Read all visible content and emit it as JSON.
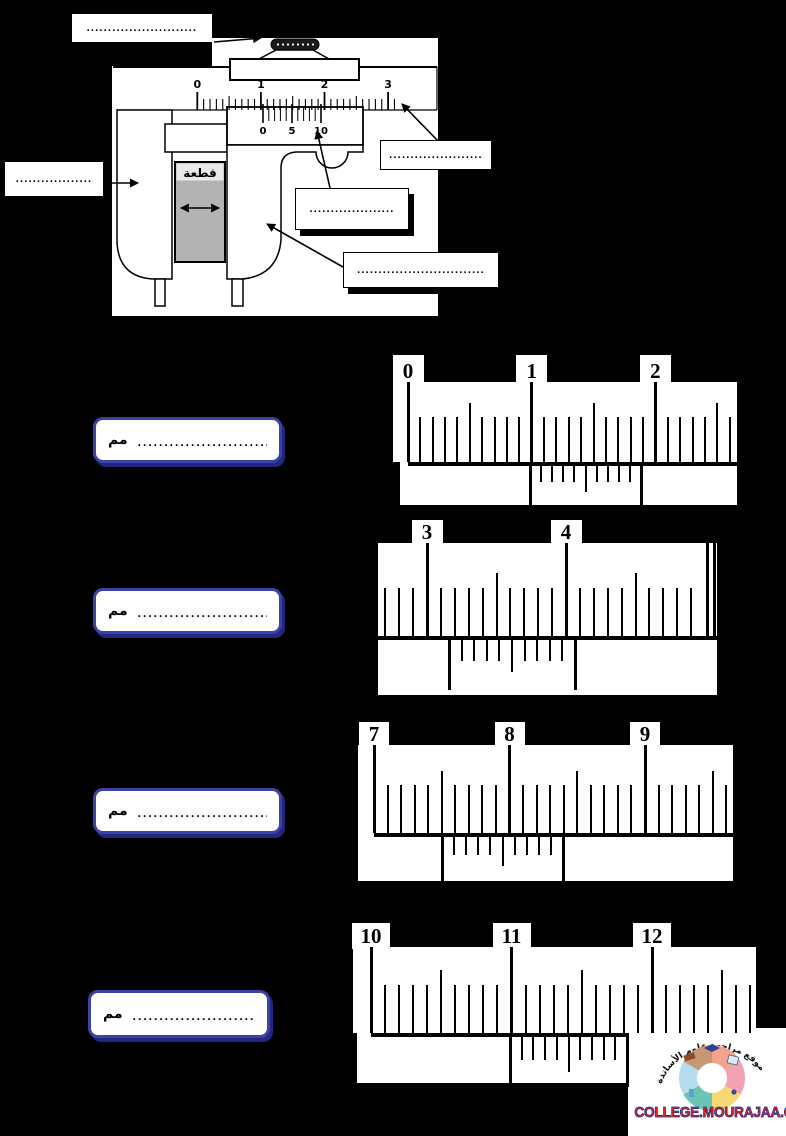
{
  "page": {
    "bg": "#000000",
    "width": 786,
    "height": 1136
  },
  "diagram": {
    "piece_label": "قطعة",
    "main_scale_numbers": [
      "0",
      "1",
      "2",
      "3"
    ],
    "vernier_scale_numbers": [
      "0",
      "5",
      "10"
    ],
    "main_scale": {
      "x0": 197.3,
      "spacing": 6.36,
      "count": 32,
      "y2": 110,
      "y_major": 92,
      "y_half": 96,
      "y_minor": 99,
      "num_y": 90
    },
    "vernier_scale": {
      "x0": 263,
      "spacing": 5.8,
      "count": 11,
      "y1": 106,
      "y2": 121,
      "ext": 2,
      "num_y": 134
    },
    "label_boxes": {
      "top_left_dots": "..........................",
      "left_dots": "..................",
      "upper_right_dots": "......................",
      "middle_dots": "....................",
      "lower_dots": ".............................."
    }
  },
  "exercises": [
    {
      "unit_label": "مم",
      "answer_dots": ".....................................",
      "numbers": [
        "0",
        "1",
        "2"
      ],
      "answer_box": [
        93,
        417,
        189,
        46
      ],
      "geometry": {
        "main_box": [
          393,
          382,
          344,
          80
        ],
        "tab_y": 355,
        "tab_h": 27,
        "tab_w": 31,
        "x0": 408,
        "spacing": 12.37,
        "i_min": 0,
        "i_max": 26,
        "h_major": 80,
        "h_half": 59,
        "h_minor": 45,
        "baseline": [
          408,
          737,
          462,
          4
        ],
        "vbox": [
          400,
          462,
          337,
          43
        ],
        "vernier": {
          "x0": 530,
          "spacing": 11.1,
          "short": 16,
          "mid": 26,
          "edge": 43,
          "zero_len": 43
        }
      }
    },
    {
      "unit_label": "مم",
      "answer_dots": ".....................................",
      "numbers": [
        "3",
        "4"
      ],
      "answer_box": [
        93,
        588,
        189,
        46
      ],
      "geometry": {
        "main_box": [
          378,
          543,
          339,
          93
        ],
        "tab_y": 520,
        "tab_h": 23,
        "tab_w": 31,
        "x0": 427,
        "spacing": 13.9,
        "i_min": -3,
        "i_max": 19,
        "h_major": 93,
        "h_half": 63,
        "h_minor": 48,
        "baseline": [
          378,
          717,
          636,
          4
        ],
        "vbox": [
          378,
          636,
          339,
          59
        ],
        "end_lines": [
          707,
          714
        ],
        "vernier": {
          "x0": 449,
          "spacing": 12.6,
          "short": 21,
          "mid": 32,
          "edge": 50,
          "zero_len": 50
        }
      }
    },
    {
      "unit_label": "مم",
      "answer_dots": "....................................",
      "numbers": [
        "7",
        "8",
        "9"
      ],
      "answer_box": [
        93,
        788,
        189,
        46
      ],
      "geometry": {
        "main_box": [
          358,
          745,
          375,
          88
        ],
        "tab_y": 722,
        "tab_h": 23,
        "tab_w": 30,
        "x0": 374,
        "spacing": 13.55,
        "i_min": 0,
        "i_max": 26,
        "h_major": 88,
        "h_half": 62,
        "h_minor": 48,
        "baseline": [
          374,
          733,
          833,
          4
        ],
        "vbox": [
          358,
          833,
          375,
          48
        ],
        "vernier": {
          "x0": 442,
          "spacing": 12.1,
          "short": 18,
          "mid": 29,
          "edge": 48,
          "zero_len": 48
        }
      }
    },
    {
      "unit_label": "مم",
      "answer_dots": ".............................",
      "numbers": [
        "10",
        "11",
        "12"
      ],
      "answer_box": [
        88,
        990,
        182,
        48
      ],
      "geometry": {
        "main_box": [
          353,
          947,
          403,
          86
        ],
        "tab_y": 923,
        "tab_h": 24,
        "tab_w": 38,
        "x0": 371,
        "spacing": 14.05,
        "i_min": 0,
        "i_max": 27,
        "h_major": 86,
        "h_half": 63,
        "h_minor": 48,
        "baseline": [
          371,
          627,
          1033,
          4
        ],
        "vbox": [
          357,
          1033,
          270,
          50
        ],
        "vernier": {
          "x0": 510,
          "spacing": 11.7,
          "short": 23,
          "mid": 35,
          "edge": 50,
          "zero_len": 62
        }
      }
    }
  ],
  "footer": {
    "site_name": "COLLEGE.MOURAJAA.COM",
    "logo_text_arabic": "موقع مراجعة علوم الأساتذة",
    "ring_colors": [
      "#f2a48f",
      "#f0a3b5",
      "#f5d973",
      "#6cc4b4",
      "#b5dcef",
      "#c69873"
    ]
  }
}
